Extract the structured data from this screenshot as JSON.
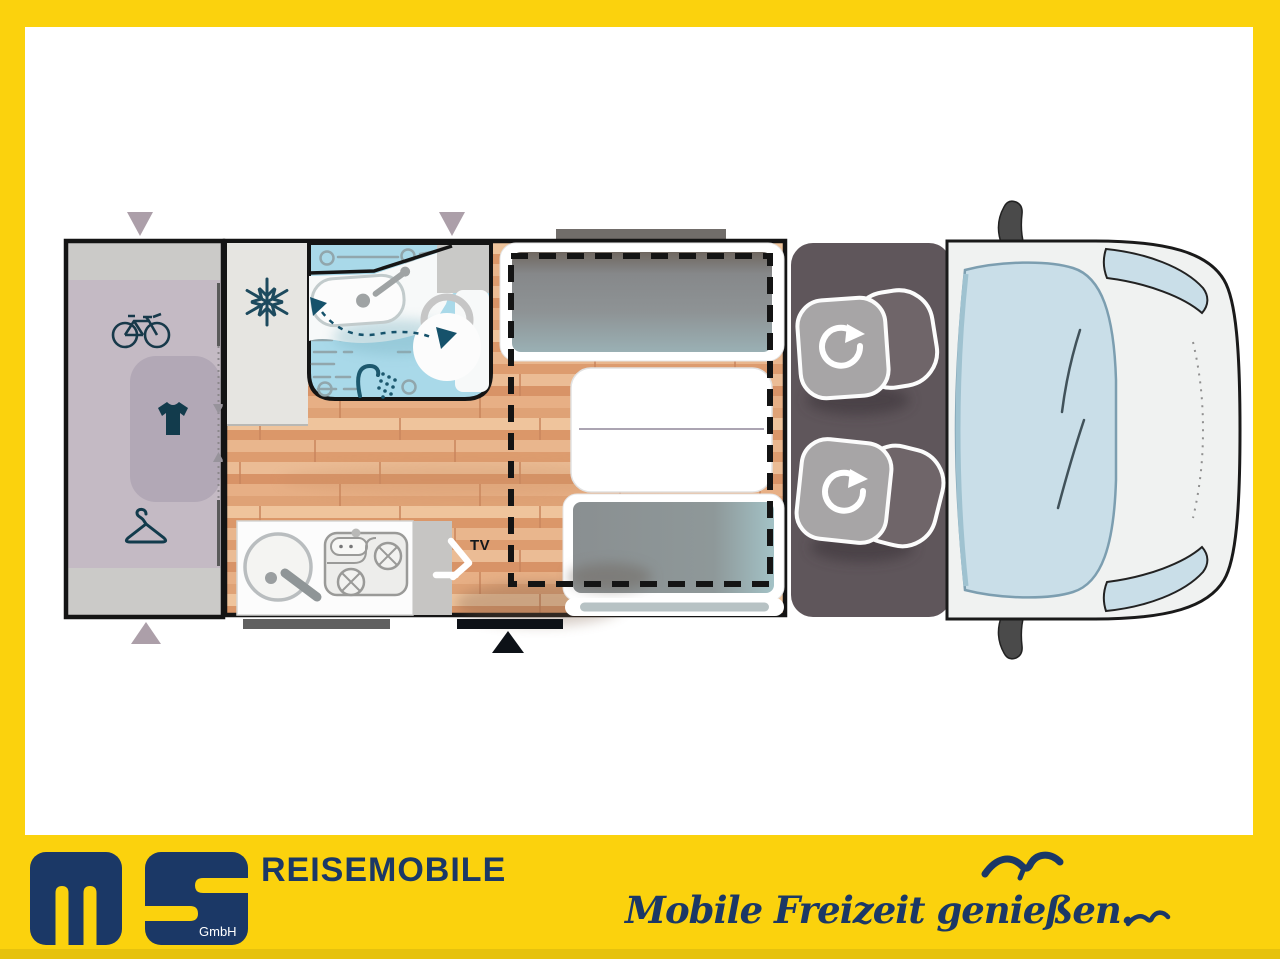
{
  "frame": {
    "yellow": "#FBD20D",
    "navy": "#1B3866"
  },
  "floorplan": {
    "tv_label": "TV",
    "colors": {
      "wood_floor": "#E5AA7F",
      "garage_lavender": "#C4BAC4",
      "wardrobe": "#B2A8B6",
      "bathroom_blue": "#A9D9E9",
      "cab_gray": "#5F565B",
      "bench_cushion_gray": "#8E9395",
      "window_marker_mauve": "#AC9FA9",
      "wall_black": "#151515",
      "icon_teal": "#17394A"
    },
    "icons": {
      "garage": [
        "bicycle-icon",
        "tshirt-icon",
        "hanger-icon"
      ],
      "fridge": "snowflake-icon",
      "bathroom": [
        "sink-icon",
        "shower-icon",
        "toilet-icon",
        "swivel-wall-arrow-icon"
      ],
      "kitchen": [
        "round-sink-icon",
        "two-burner-stove-icon"
      ],
      "media": "tv-mount-icon",
      "cab": [
        "swivel-seat-icon",
        "swivel-seat-icon"
      ],
      "markers": [
        "window-arrow-down",
        "window-arrow-down",
        "window-arrow-up",
        "entry-door-arrow-up"
      ]
    }
  },
  "footer": {
    "logo": {
      "gmbh": "GmbH"
    },
    "title": "REISEMOBILE",
    "slogan": "Mobile Freizeit genießen.",
    "icons": [
      "seagull-icon-large",
      "seagull-icon-small"
    ]
  }
}
